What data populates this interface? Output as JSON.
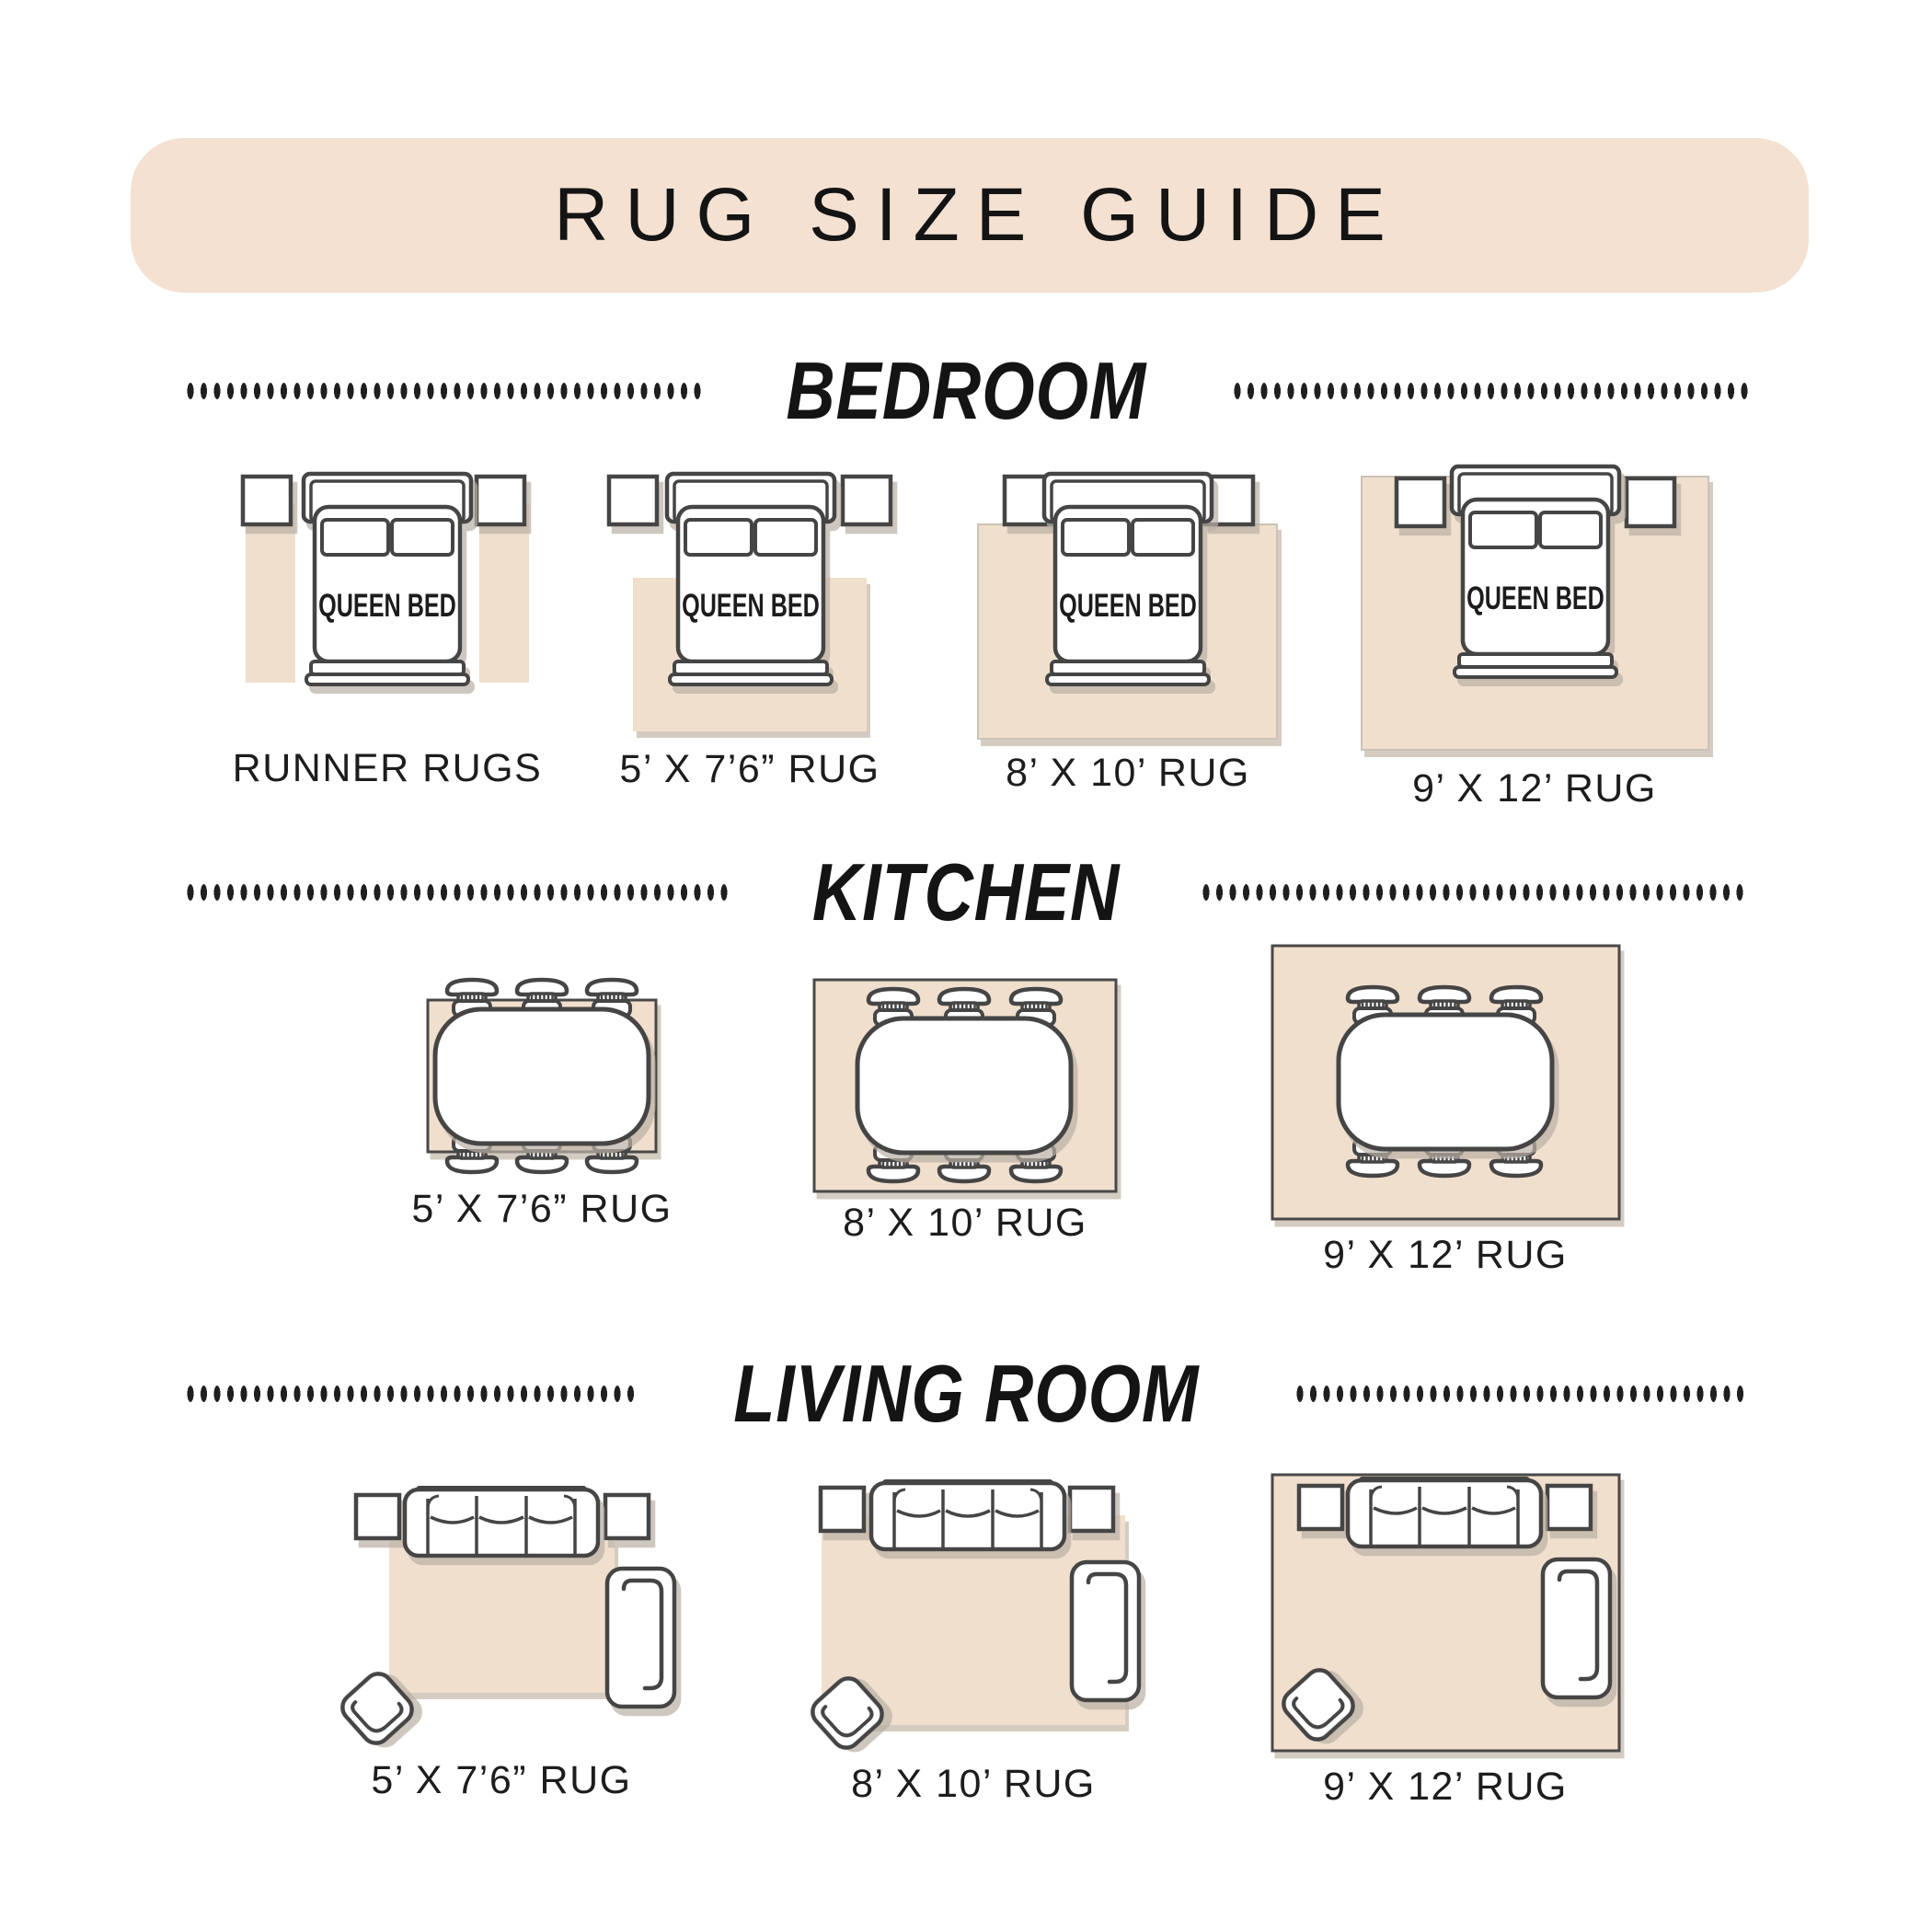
{
  "title_banner": {
    "label": "RUG SIZE GUIDE"
  },
  "colors": {
    "banner_bg": "#f4e1d1",
    "rug_fill": "#f1dfcd",
    "furniture_outline": "#454545",
    "rug_dark_border": "#4a4a4a",
    "text": "#1d1d1d"
  },
  "sections": {
    "bedroom": {
      "title": "BEDROOM",
      "items": [
        {
          "label": "RUNNER RUGS",
          "bed_label": "QUEEN BED"
        },
        {
          "label": "5’ X 7’6” RUG",
          "bed_label": "QUEEN BED"
        },
        {
          "label": "8’ X 10’ RUG",
          "bed_label": "QUEEN BED"
        },
        {
          "label": "9’ X 12’ RUG",
          "bed_label": "QUEEN BED"
        }
      ]
    },
    "kitchen": {
      "title": "KITCHEN",
      "items": [
        {
          "label": "5’ X 7’6” RUG"
        },
        {
          "label": "8’ X 10’ RUG"
        },
        {
          "label": "9’ X 12’ RUG"
        }
      ]
    },
    "living_room": {
      "title": "LIVING ROOM",
      "items": [
        {
          "label": "5’ X 7’6” RUG"
        },
        {
          "label": "8’ X 10’ RUG"
        },
        {
          "label": "9’ X 12’ RUG"
        }
      ]
    }
  }
}
